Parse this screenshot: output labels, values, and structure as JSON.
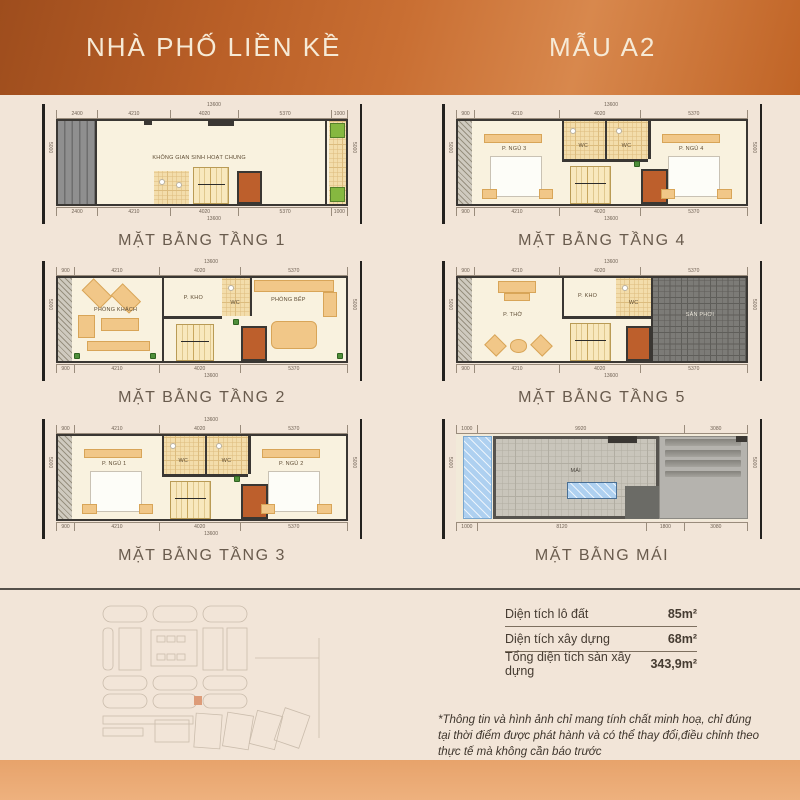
{
  "header": {
    "left_title": "NHÀ PHỐ LIỀN KỀ",
    "right_title": "MẪU A2"
  },
  "plans": {
    "floor1": {
      "caption": "MẶT BẰNG TẦNG 1",
      "total": "13600",
      "segments": [
        "2400",
        "4210",
        "4020",
        "5370",
        "1000"
      ],
      "side": "5000",
      "room": "KHÔNG GIAN SINH HOẠT CHUNG"
    },
    "floor2": {
      "caption": "MẶT BẰNG TẦNG 2",
      "total": "13600",
      "segments": [
        "900",
        "4210",
        "4020",
        "5370"
      ],
      "side": "5000",
      "rooms": {
        "living": "PHÒNG KHÁCH",
        "storage": "P. KHO",
        "wc": "WC",
        "kitchen": "PHÒNG BẾP"
      }
    },
    "floor3": {
      "caption": "MẶT BẰNG TẦNG 3",
      "total": "13600",
      "segments": [
        "900",
        "4210",
        "4020",
        "5370"
      ],
      "side": "5000",
      "rooms": {
        "bed1": "P. NGỦ 1",
        "wc1": "WC",
        "wc2": "WC",
        "bed2": "P. NGỦ 2"
      }
    },
    "floor4": {
      "caption": "MẶT BẰNG TẦNG 4",
      "total": "13600",
      "segments": [
        "900",
        "4210",
        "4020",
        "5370"
      ],
      "side": "5000",
      "rooms": {
        "bed1": "P. NGỦ 3",
        "wc1": "WC",
        "wc2": "WC",
        "bed2": "P. NGỦ 4"
      }
    },
    "floor5": {
      "caption": "MẶT BẰNG TẦNG 5",
      "total": "13600",
      "segments": [
        "900",
        "4210",
        "4020",
        "5370"
      ],
      "side": "5000",
      "rooms": {
        "altar": "P. THỜ",
        "storage": "P. KHO",
        "wc": "WC",
        "terrace": "SÂN PHƠI"
      }
    },
    "roof": {
      "caption": "MẶT BẰNG MÁI",
      "top_segments": [
        "1000",
        "9920",
        "3080"
      ],
      "bottom_segments": [
        "1000",
        "8120",
        "1800",
        "3080"
      ],
      "side": "5000",
      "room": "MÁI"
    }
  },
  "info_table": {
    "rows": [
      {
        "label": "Diện tích lô đất",
        "value": "85m²"
      },
      {
        "label": "Diện tích xây dựng",
        "value": "68m²"
      },
      {
        "label": "Tổng diện tích sàn xây dựng",
        "value": "343,9m²"
      }
    ]
  },
  "disclaimer": "*Thông tin và hình ảnh chỉ mang tính chất minh hoạ, chỉ đúng tại thời điểm được phát hành và có thể thay đổi,điều chỉnh theo thực tế mà không cần báo trước",
  "colors": {
    "header_orange_dark": "#9e4d1d",
    "header_orange_light": "#d8884d",
    "footer_orange": "#e7a36b",
    "background_cream": "#f2e5d8",
    "plan_wall": "#3a3733",
    "elevator_orange": "#bd5f2c",
    "furniture_tan": "#f1c788",
    "highlight_lot_orange": "#cd5f2a"
  }
}
